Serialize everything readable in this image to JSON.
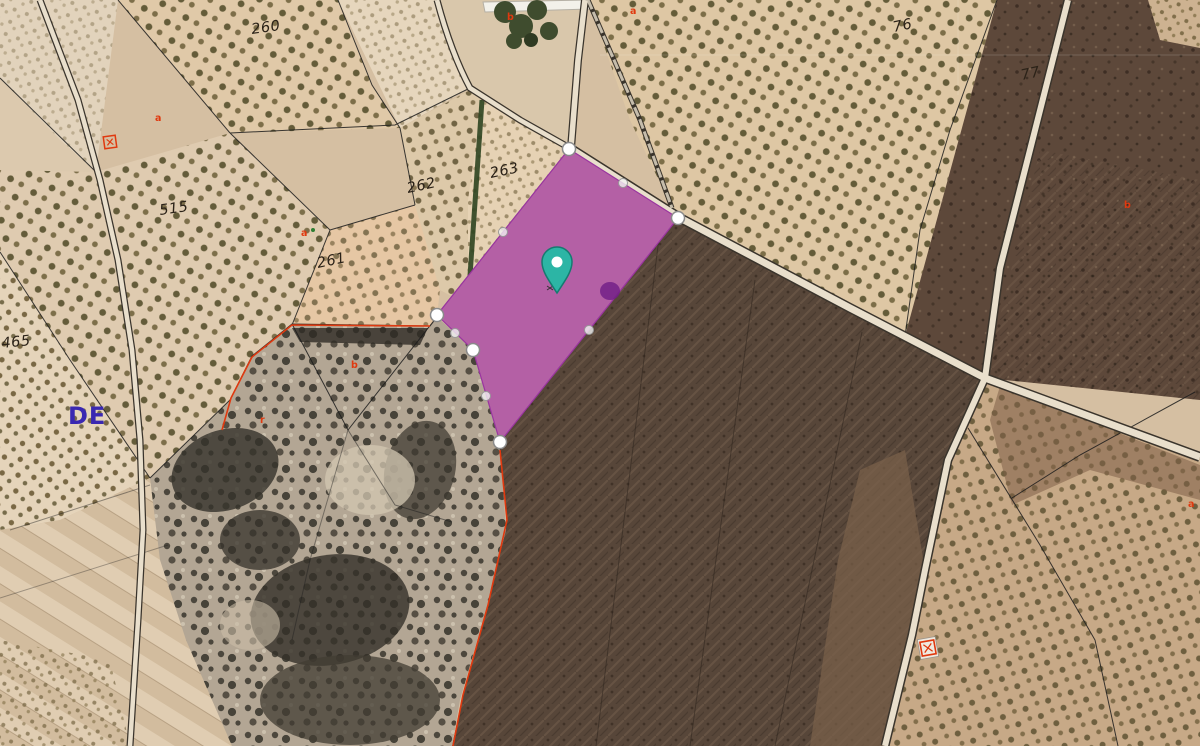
{
  "map": {
    "view": "satellite-cadastral-aerial",
    "accent_colors": {
      "selected_parcel_fill": "#c447c4",
      "pin_teal": "#2cb5a5",
      "boundary_red": "#e0390f",
      "area_label_blue": "#3a28b2",
      "cadastral_line": "#1c1c1c"
    },
    "parcel_labels": [
      {
        "text": "260"
      },
      {
        "text": "515"
      },
      {
        "text": "262"
      },
      {
        "text": "263"
      },
      {
        "text": "261"
      },
      {
        "text": "465"
      },
      {
        "text": "76"
      },
      {
        "text": "77"
      }
    ],
    "subparcel_letters": [
      {
        "text": "a"
      },
      {
        "text": "a"
      },
      {
        "text": "b"
      },
      {
        "text": "a"
      },
      {
        "text": "b"
      },
      {
        "text": "r"
      },
      {
        "text": "b"
      },
      {
        "text": "a"
      }
    ],
    "area_label": {
      "text": "DE"
    },
    "selected_parcel": {
      "vertex_count": 5,
      "midpoint_count": 5
    },
    "pin_icon": "location-pin"
  }
}
